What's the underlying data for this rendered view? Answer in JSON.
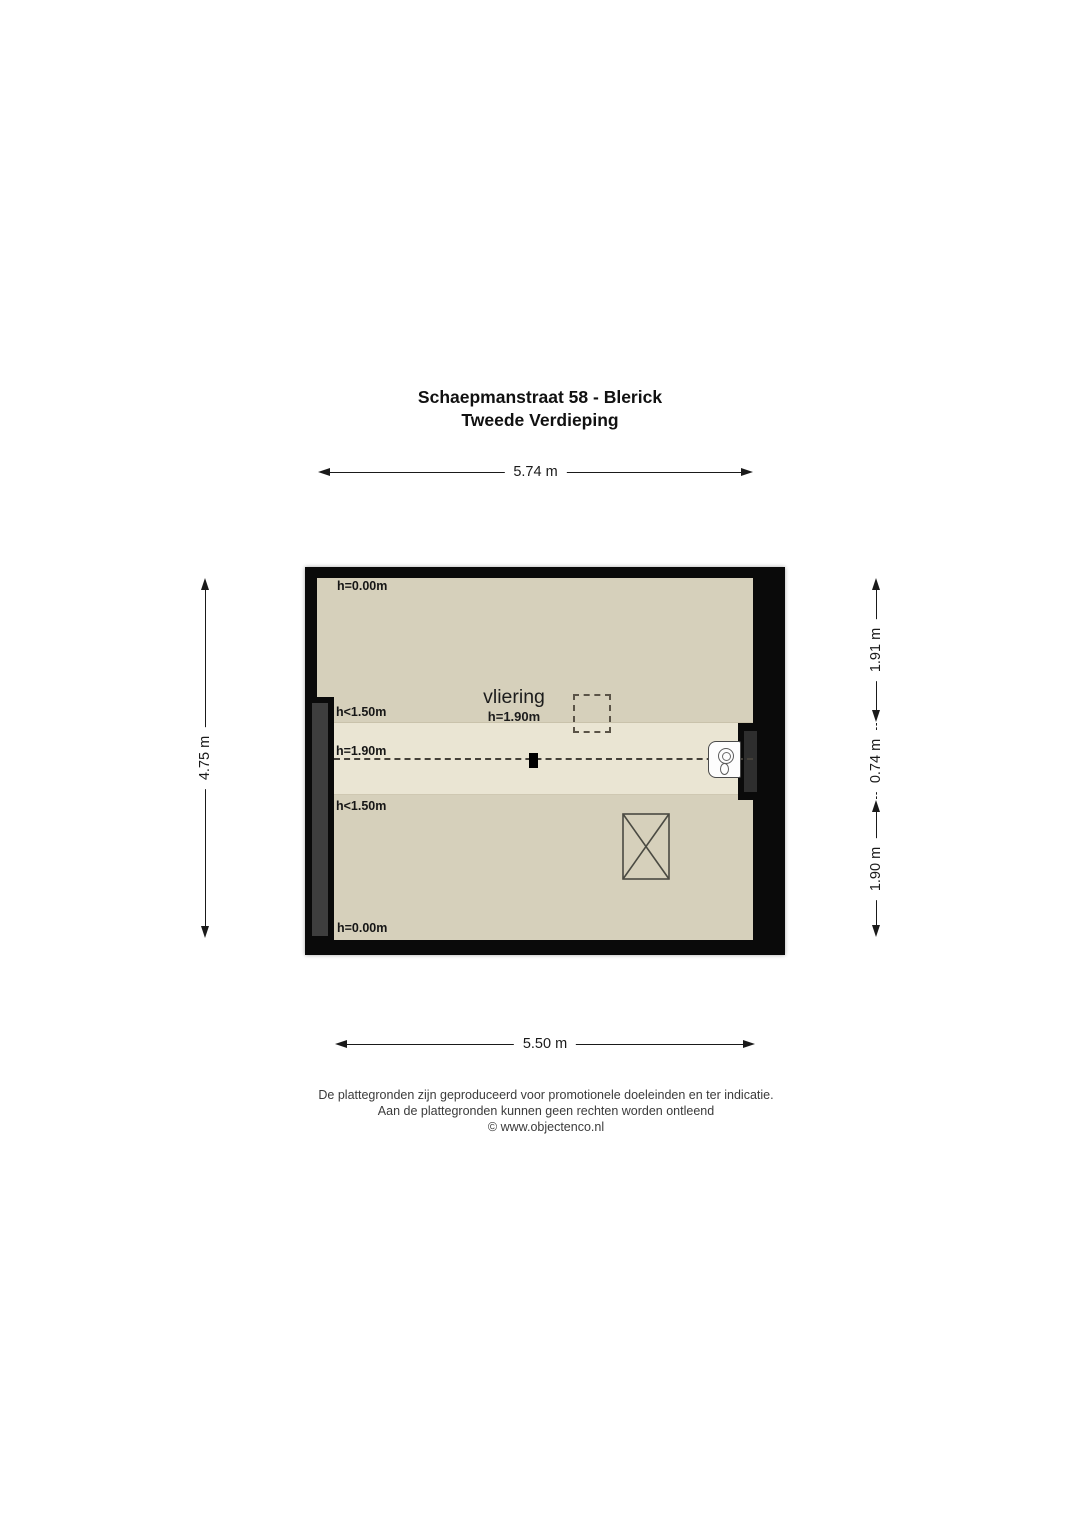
{
  "title": {
    "line1": "Schaepmanstraat 58 - Blerick",
    "line2": "Tweede Verdieping"
  },
  "dimensions": {
    "top": "5.74 m",
    "bottom": "5.50 m",
    "left": "4.75 m",
    "right_top": "1.91 m",
    "right_middle": "0.74 m",
    "right_bottom": "1.90 m"
  },
  "plan": {
    "room": {
      "name": "vliering",
      "height": "h=1.90m"
    },
    "height_labels": {
      "top": "h=0.00m",
      "upper": "h<1.50m",
      "middle": "h=1.90m",
      "lower": "h<1.50m",
      "bottom": "h=0.00m"
    },
    "colors": {
      "wall": "#0a0a0a",
      "floor": "#d6d0bb",
      "floor_high_zone": "#eae5d3",
      "knee_wall_gray": "#3e3e3e",
      "chimney_gray": "#2e2e2e"
    },
    "icons": {
      "boiler": "boiler-top-view-circle-dial",
      "stair_opening": "rectangle-with-x-cross",
      "roof_hatch": "dashed-square",
      "support_post": "small-black-square",
      "ridge_line": "horizontal-dashed-line"
    }
  },
  "footer": {
    "line1": "De plattegronden zijn geproduceerd voor promotionele doeleinden en ter indicatie.",
    "line2": "Aan de plattegronden kunnen geen rechten worden ontleend",
    "line3": "© www.objectenco.nl"
  }
}
